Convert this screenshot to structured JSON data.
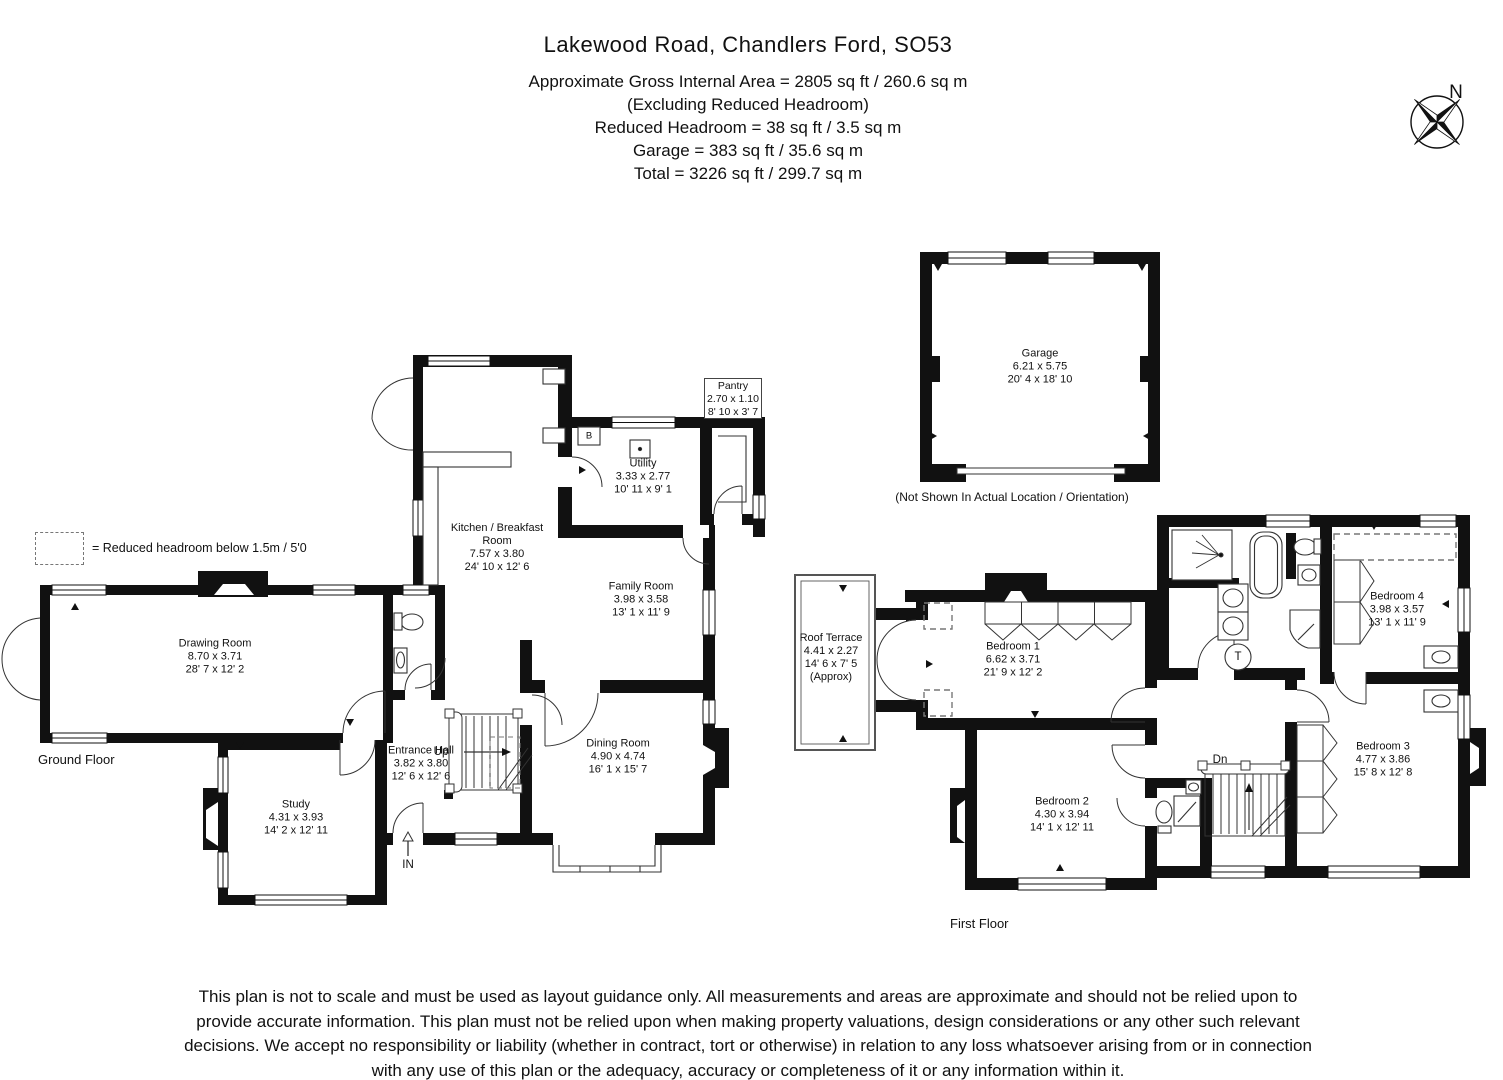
{
  "header": {
    "title": "Lakewood Road, Chandlers Ford, SO53",
    "area_lines": [
      "Approximate Gross Internal Area = 2805 sq ft / 260.6 sq m",
      "(Excluding Reduced Headroom)",
      "Reduced Headroom = 38 sq ft / 3.5 sq m",
      "Garage = 383 sq ft / 35.6 sq m",
      "Total = 3226 sq ft / 299.7 sq m"
    ]
  },
  "compass": {
    "north_label": "N"
  },
  "legend": {
    "reduced_headroom": "= Reduced headroom below 1.5m / 5'0"
  },
  "ground_floor": {
    "label": "Ground Floor",
    "rooms": {
      "drawing_room": {
        "name": "Drawing Room",
        "metric": "8.70 x 3.71",
        "imperial": "28' 7 x 12' 2"
      },
      "study": {
        "name": "Study",
        "metric": "4.31 x 3.93",
        "imperial": "14' 2 x 12' 11"
      },
      "entrance_hall": {
        "name": "Entrance Hall",
        "metric": "3.82 x 3.80",
        "imperial": "12' 6 x 12' 6"
      },
      "kitchen": {
        "name": "Kitchen / Breakfast Room",
        "metric": "7.57 x 3.80",
        "imperial": "24' 10 x 12' 6"
      },
      "utility": {
        "name": "Utility",
        "metric": "3.33 x 2.77",
        "imperial": "10' 11 x 9' 1"
      },
      "pantry": {
        "name": "Pantry",
        "metric": "2.70 x 1.10",
        "imperial": "8' 10 x 3' 7"
      },
      "family_room": {
        "name": "Family Room",
        "metric": "3.98 x 3.58",
        "imperial": "13' 1 x 11' 9"
      },
      "dining_room": {
        "name": "Dining Room",
        "metric": "4.90 x 4.74",
        "imperial": "16' 1 x 15' 7"
      }
    },
    "markers": {
      "up": "Up",
      "in": "IN",
      "boiler": "B"
    }
  },
  "first_floor": {
    "label": "First Floor",
    "rooms": {
      "roof_terrace": {
        "name": "Roof Terrace",
        "metric": "4.41 x 2.27",
        "imperial": "14' 6 x 7' 5",
        "note": "(Approx)"
      },
      "bedroom_1": {
        "name": "Bedroom 1",
        "metric": "6.62 x 3.71",
        "imperial": "21' 9 x 12' 2"
      },
      "bedroom_2": {
        "name": "Bedroom 2",
        "metric": "4.30 x 3.94",
        "imperial": "14' 1 x 12' 11"
      },
      "bedroom_3": {
        "name": "Bedroom 3",
        "metric": "4.77 x 3.86",
        "imperial": "15' 8 x 12' 8"
      },
      "bedroom_4": {
        "name": "Bedroom 4",
        "metric": "3.98 x 3.57",
        "imperial": "13' 1 x 11' 9"
      }
    },
    "markers": {
      "down": "Dn",
      "tank": "T"
    }
  },
  "garage": {
    "room": {
      "name": "Garage",
      "metric": "6.21 x 5.75",
      "imperial": "20' 4 x 18' 10"
    },
    "note": "(Not Shown In Actual Location / Orientation)"
  },
  "disclaimer": "This plan is not to scale and must be used as layout guidance only. All measurements and areas are approximate and should not be relied upon to provide accurate information. This plan must not be relied upon when making property valuations, design considerations or any other such relevant decisions. We accept no responsibility or liability (whether in contract, tort or otherwise) in relation to any loss whatsoever arising from or in connection with any use of this plan or the adequacy, accuracy or completeness of it or any information within it."
}
